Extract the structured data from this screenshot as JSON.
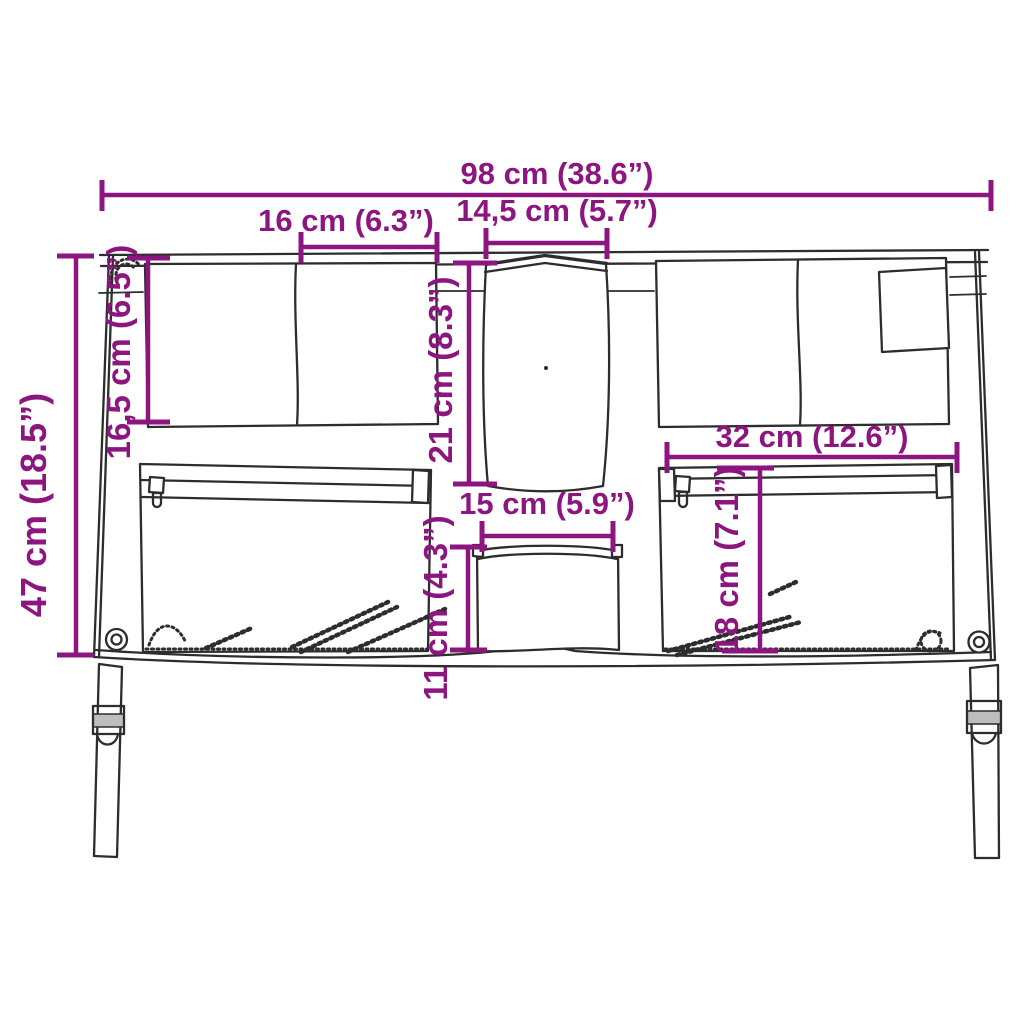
{
  "figure": {
    "kind": "product-dimension-diagram",
    "subject": "hanging organizer panel with pockets and two straps"
  },
  "colors": {
    "background": "#ffffff",
    "drawing_line": "#2d2d2d",
    "dimension_accent": "#8d1580"
  },
  "units": {
    "primary": "cm",
    "secondary": "inches"
  },
  "dimensions": {
    "overall_width": {
      "label": "98 cm (38.6”)",
      "cm": 98,
      "inches": 38.6
    },
    "left_top_pocket_width": {
      "label": "16 cm (6.3”)",
      "cm": 16,
      "inches": 6.3
    },
    "middle_pocket_width": {
      "label": "14,5 cm (5.7”)",
      "cm": 14.5,
      "inches": 5.7
    },
    "overall_height": {
      "label": "47 cm (18.5”)",
      "cm": 47,
      "inches": 18.5
    },
    "left_top_pocket_height": {
      "label": "16,5 cm (6.5”)",
      "cm": 16.5,
      "inches": 6.5
    },
    "middle_pocket_height": {
      "label": "21 cm (8.3”)",
      "cm": 21,
      "inches": 8.3
    },
    "bottom_middle_pocket_width": {
      "label": "15 cm (5.9”)",
      "cm": 15,
      "inches": 5.9
    },
    "bottom_middle_pocket_height": {
      "label": "11 cm (4.3”)",
      "cm": 11,
      "inches": 4.3
    },
    "right_zip_pocket_width": {
      "label": "32 cm (12.6”)",
      "cm": 32,
      "inches": 12.6
    },
    "right_zip_pocket_height": {
      "label": "18 cm (7.1”)",
      "cm": 18,
      "inches": 7.1
    }
  }
}
